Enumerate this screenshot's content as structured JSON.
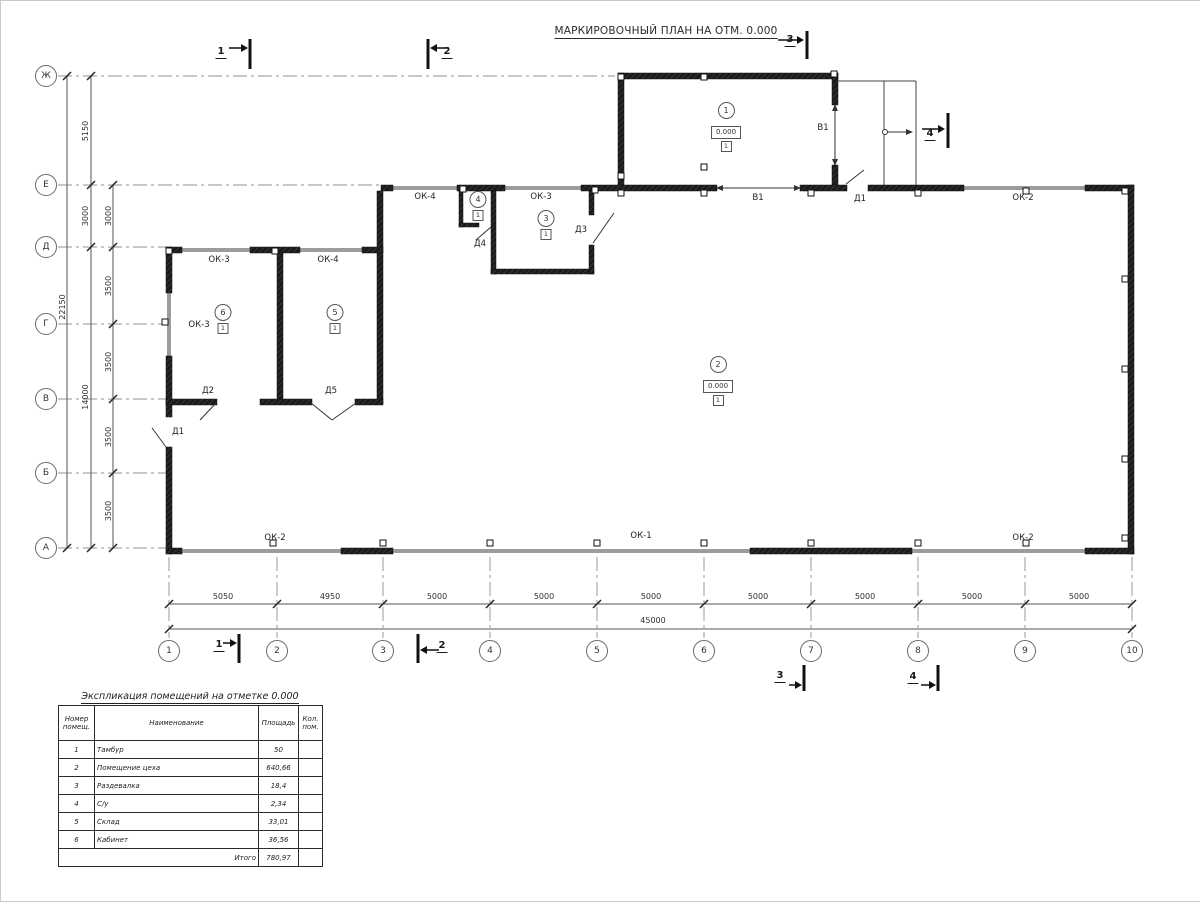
{
  "plan": {
    "title": "МАРКИРОВОЧНЫЙ ПЛАН НА ОТМ. 0.000"
  },
  "axes": {
    "rows": [
      {
        "label": "Ж",
        "y": 75
      },
      {
        "label": "Е",
        "y": 184
      },
      {
        "label": "Д",
        "y": 246
      },
      {
        "label": "Г",
        "y": 323
      },
      {
        "label": "В",
        "y": 398
      },
      {
        "label": "Б",
        "y": 472
      },
      {
        "label": "А",
        "y": 547
      }
    ],
    "cols": [
      {
        "label": "1",
        "x": 168
      },
      {
        "label": "2",
        "x": 276
      },
      {
        "label": "3",
        "x": 382
      },
      {
        "label": "4",
        "x": 489
      },
      {
        "label": "5",
        "x": 596
      },
      {
        "label": "6",
        "x": 703
      },
      {
        "label": "7",
        "x": 810
      },
      {
        "label": "8",
        "x": 917
      },
      {
        "label": "9",
        "x": 1024
      },
      {
        "label": "10",
        "x": 1131
      }
    ]
  },
  "rooms": [
    {
      "num": "1",
      "elev": "0.000",
      "floor": "1",
      "x": 725,
      "y": 110
    },
    {
      "num": "2",
      "elev": "0.000",
      "floor": "1",
      "x": 717,
      "y": 364
    },
    {
      "num": "3",
      "floor": "1",
      "x": 545,
      "y": 218
    },
    {
      "num": "4",
      "floor": "1",
      "x": 477,
      "y": 199
    },
    {
      "num": "5",
      "floor": "1",
      "x": 334,
      "y": 312
    },
    {
      "num": "6",
      "floor": "1",
      "x": 222,
      "y": 312
    }
  ],
  "annotations": [
    {
      "t": "ОК-4",
      "x": 424,
      "y": 196,
      "n": "window-label"
    },
    {
      "t": "ОК-3",
      "x": 540,
      "y": 196,
      "n": "window-label"
    },
    {
      "t": "Д4",
      "x": 479,
      "y": 243,
      "n": "door-label"
    },
    {
      "t": "Д3",
      "x": 580,
      "y": 229,
      "n": "door-label"
    },
    {
      "t": "В1",
      "x": 822,
      "y": 127,
      "n": "gate-label"
    },
    {
      "t": "В1",
      "x": 757,
      "y": 197,
      "n": "gate-label"
    },
    {
      "t": "Д1",
      "x": 859,
      "y": 198,
      "n": "door-label"
    },
    {
      "t": "ОК-2",
      "x": 1022,
      "y": 197,
      "n": "window-label"
    },
    {
      "t": "ОК-3",
      "x": 218,
      "y": 259,
      "n": "window-label"
    },
    {
      "t": "ОК-4",
      "x": 327,
      "y": 259,
      "n": "window-label"
    },
    {
      "t": "ОК-3",
      "x": 198,
      "y": 324,
      "n": "window-label"
    },
    {
      "t": "Д2",
      "x": 207,
      "y": 390,
      "n": "door-label"
    },
    {
      "t": "Д5",
      "x": 330,
      "y": 390,
      "n": "door-label"
    },
    {
      "t": "Д1",
      "x": 177,
      "y": 431,
      "n": "door-label"
    },
    {
      "t": "ОК-2",
      "x": 274,
      "y": 537,
      "n": "window-label"
    },
    {
      "t": "ОК-1",
      "x": 640,
      "y": 535,
      "n": "window-label"
    },
    {
      "t": "ОК-2",
      "x": 1022,
      "y": 537,
      "n": "window-label"
    },
    {
      "t": "5050",
      "x": 222,
      "y": 596,
      "cls": "dim",
      "n": "dimension-label"
    },
    {
      "t": "4950",
      "x": 329,
      "y": 596,
      "cls": "dim",
      "n": "dimension-label"
    },
    {
      "t": "5000",
      "x": 436,
      "y": 596,
      "cls": "dim",
      "n": "dimension-label"
    },
    {
      "t": "5000",
      "x": 543,
      "y": 596,
      "cls": "dim",
      "n": "dimension-label"
    },
    {
      "t": "5000",
      "x": 650,
      "y": 596,
      "cls": "dim",
      "n": "dimension-label"
    },
    {
      "t": "5000",
      "x": 757,
      "y": 596,
      "cls": "dim",
      "n": "dimension-label"
    },
    {
      "t": "5000",
      "x": 864,
      "y": 596,
      "cls": "dim",
      "n": "dimension-label"
    },
    {
      "t": "5000",
      "x": 971,
      "y": 596,
      "cls": "dim",
      "n": "dimension-label"
    },
    {
      "t": "5000",
      "x": 1078,
      "y": 596,
      "cls": "dim",
      "n": "dimension-label"
    },
    {
      "t": "45000",
      "x": 652,
      "y": 620,
      "cls": "dim",
      "n": "dimension-label"
    },
    {
      "t": "22150",
      "x": 62,
      "y": 306,
      "cls": "dim rot",
      "n": "dimension-label"
    },
    {
      "t": "5150",
      "x": 85,
      "y": 130,
      "cls": "dim rot",
      "n": "dimension-label"
    },
    {
      "t": "3000",
      "x": 85,
      "y": 215,
      "cls": "dim rot",
      "n": "dimension-label"
    },
    {
      "t": "14000",
      "x": 85,
      "y": 396,
      "cls": "dim rot",
      "n": "dimension-label"
    },
    {
      "t": "3000",
      "x": 108,
      "y": 215,
      "cls": "dim rot",
      "n": "dimension-label"
    },
    {
      "t": "3500",
      "x": 108,
      "y": 285,
      "cls": "dim rot",
      "n": "dimension-label"
    },
    {
      "t": "3500",
      "x": 108,
      "y": 361,
      "cls": "dim rot",
      "n": "dimension-label"
    },
    {
      "t": "3500",
      "x": 108,
      "y": 436,
      "cls": "dim rot",
      "n": "dimension-label"
    },
    {
      "t": "3500",
      "x": 108,
      "y": 510,
      "cls": "dim rot",
      "n": "dimension-label"
    },
    {
      "t": "1",
      "x": 220,
      "y": 52,
      "cls": "sec",
      "n": "section-label"
    },
    {
      "t": "2",
      "x": 446,
      "y": 52,
      "cls": "sec",
      "n": "section-label"
    },
    {
      "t": "3",
      "x": 789,
      "y": 40,
      "cls": "sec",
      "n": "section-label"
    },
    {
      "t": "4",
      "x": 929,
      "y": 134,
      "cls": "sec",
      "n": "section-label"
    },
    {
      "t": "1",
      "x": 218,
      "y": 645,
      "cls": "sec",
      "n": "section-label"
    },
    {
      "t": "2",
      "x": 441,
      "y": 646,
      "cls": "sec",
      "n": "section-label"
    },
    {
      "t": "3",
      "x": 779,
      "y": 676,
      "cls": "sec",
      "n": "section-label"
    },
    {
      "t": "4",
      "x": 912,
      "y": 677,
      "cls": "sec",
      "n": "section-label"
    }
  ],
  "schedule": {
    "title": "Экспликация помещений на отметке 0.000",
    "headers": [
      "Номер помещ.",
      "Наименование",
      "Площадь",
      "Кол. пом."
    ],
    "rows": [
      [
        "1",
        "Тамбур",
        "50",
        ""
      ],
      [
        "2",
        "Помещение цеха",
        "640,66",
        ""
      ],
      [
        "3",
        "Раздевалка",
        "18,4",
        ""
      ],
      [
        "4",
        "С/у",
        "2,34",
        ""
      ],
      [
        "5",
        "Склад",
        "33,01",
        ""
      ],
      [
        "6",
        "Кабинет",
        "36,56",
        ""
      ]
    ],
    "total_label": "Итого",
    "total_value": "780,97"
  },
  "colors": {
    "wall": "#1b1b1b",
    "window": "#9c9c9c",
    "axis_line": "#909090",
    "text": "#222222"
  }
}
